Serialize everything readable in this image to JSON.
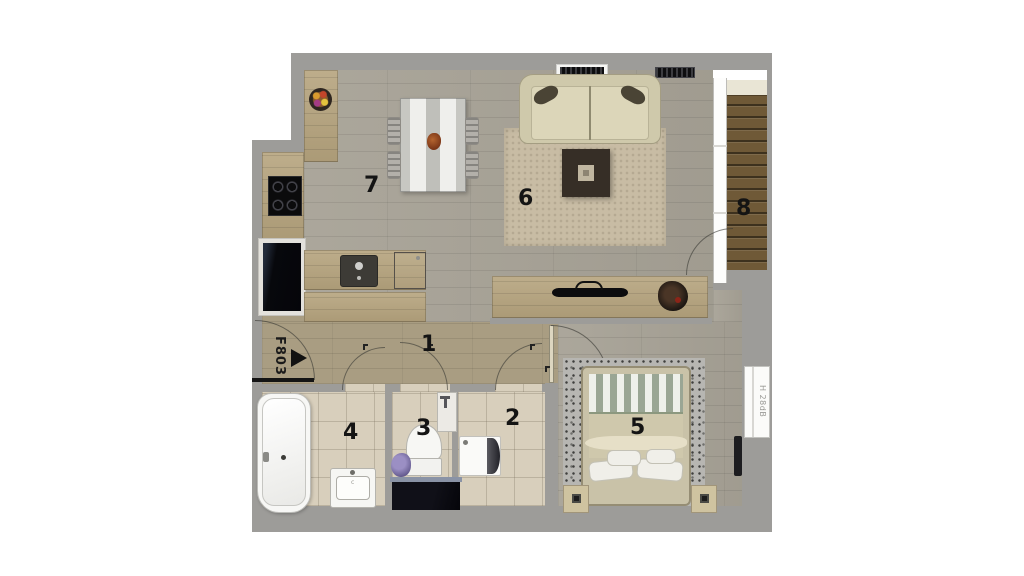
{
  "plan": {
    "rooms": [
      {
        "id": "hallway",
        "label": "1"
      },
      {
        "id": "storage",
        "label": "2"
      },
      {
        "id": "wc",
        "label": "3"
      },
      {
        "id": "bathroom",
        "label": "4"
      },
      {
        "id": "bedroom",
        "label": "5"
      },
      {
        "id": "living-room",
        "label": "6"
      },
      {
        "id": "kitchen-dining",
        "label": "7"
      },
      {
        "id": "balcony",
        "label": "8"
      }
    ],
    "annotations": {
      "entrance_door_code": "F803",
      "window_acoustic_rating": "H 28dB",
      "bath_sink_mark": "c"
    },
    "colors": {
      "background": "#ffffff",
      "wall": "#9d9c99",
      "floor_wood": "#a7a296",
      "floor_wood_warm": "#a99d82",
      "cabinet_oak": "#b6a47e",
      "tile": "#d8cfbc",
      "balcony_deck": "#6f5937",
      "rug_living": "#c8bca4",
      "rug_bedroom": "#b7b6b2",
      "sofa_cream": "#cfc9ab",
      "appliance_black": "#0c0c0e",
      "fixture_white": "#f5f5f2"
    }
  }
}
